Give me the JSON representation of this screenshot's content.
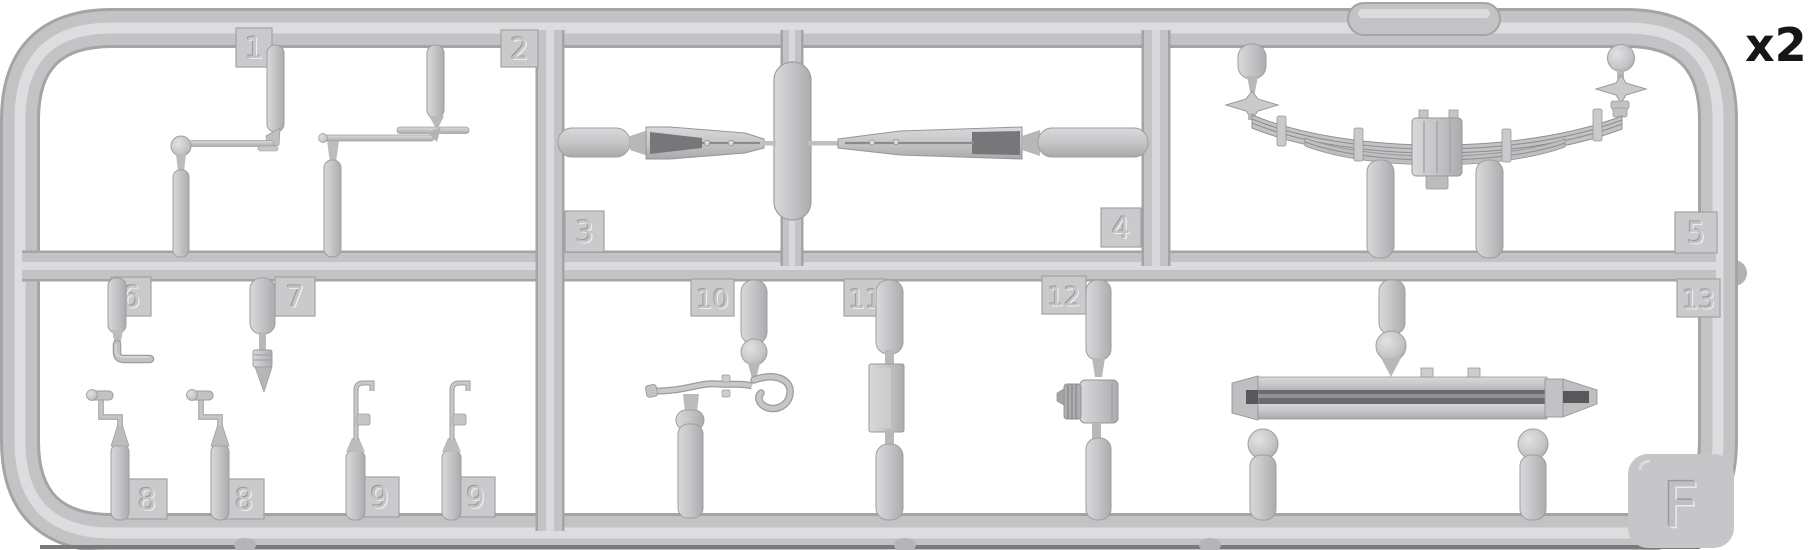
{
  "figure": {
    "kind": "model-kit-sprue-diagram",
    "description_visible_text_only": true
  },
  "annotations": {
    "quantity": "x2",
    "sprue_letter": "F"
  },
  "part_labels": [
    {
      "id": "1",
      "text": "1",
      "x": 236,
      "y": 28,
      "w": 36,
      "h": 39
    },
    {
      "id": "2",
      "text": "2",
      "x": 501,
      "y": 30,
      "w": 37,
      "h": 37
    },
    {
      "id": "3",
      "text": "3",
      "x": 565,
      "y": 211,
      "w": 39,
      "h": 41
    },
    {
      "id": "4",
      "text": "4",
      "x": 1101,
      "y": 208,
      "w": 40,
      "h": 39
    },
    {
      "id": "5",
      "text": "5",
      "x": 1675,
      "y": 212,
      "w": 42,
      "h": 41
    },
    {
      "id": "6",
      "text": "6",
      "x": 111,
      "y": 277,
      "w": 40,
      "h": 39
    },
    {
      "id": "7",
      "text": "7",
      "x": 275,
      "y": 277,
      "w": 40,
      "h": 39
    },
    {
      "id": "8a",
      "text": "8",
      "x": 127,
      "y": 479,
      "w": 40,
      "h": 40
    },
    {
      "id": "8b",
      "text": "8",
      "x": 224,
      "y": 479,
      "w": 40,
      "h": 40
    },
    {
      "id": "9a",
      "text": "9",
      "x": 360,
      "y": 477,
      "w": 39,
      "h": 40
    },
    {
      "id": "9b",
      "text": "9",
      "x": 456,
      "y": 477,
      "w": 39,
      "h": 40
    },
    {
      "id": "10",
      "text": "10",
      "x": 691,
      "y": 279,
      "w": 43,
      "h": 37
    },
    {
      "id": "11",
      "text": "11",
      "x": 844,
      "y": 279,
      "w": 42,
      "h": 37
    },
    {
      "id": "12",
      "text": "12",
      "x": 1042,
      "y": 276,
      "w": 44,
      "h": 38
    },
    {
      "id": "13",
      "text": "13",
      "x": 1677,
      "y": 279,
      "w": 43,
      "h": 38
    }
  ],
  "colors": {
    "background": "#ffffff",
    "plastic": "#c3c3c5",
    "plastic_light": "#dddddf",
    "plastic_dark": "#a4a4a6",
    "plate": "#cacacc",
    "plate_edge": "#a2a2a4",
    "emboss_dark": "#9b9b9d",
    "emboss_light": "#ededef",
    "channel_dark": "#6b6b6d",
    "annotation_text": "#161616"
  }
}
